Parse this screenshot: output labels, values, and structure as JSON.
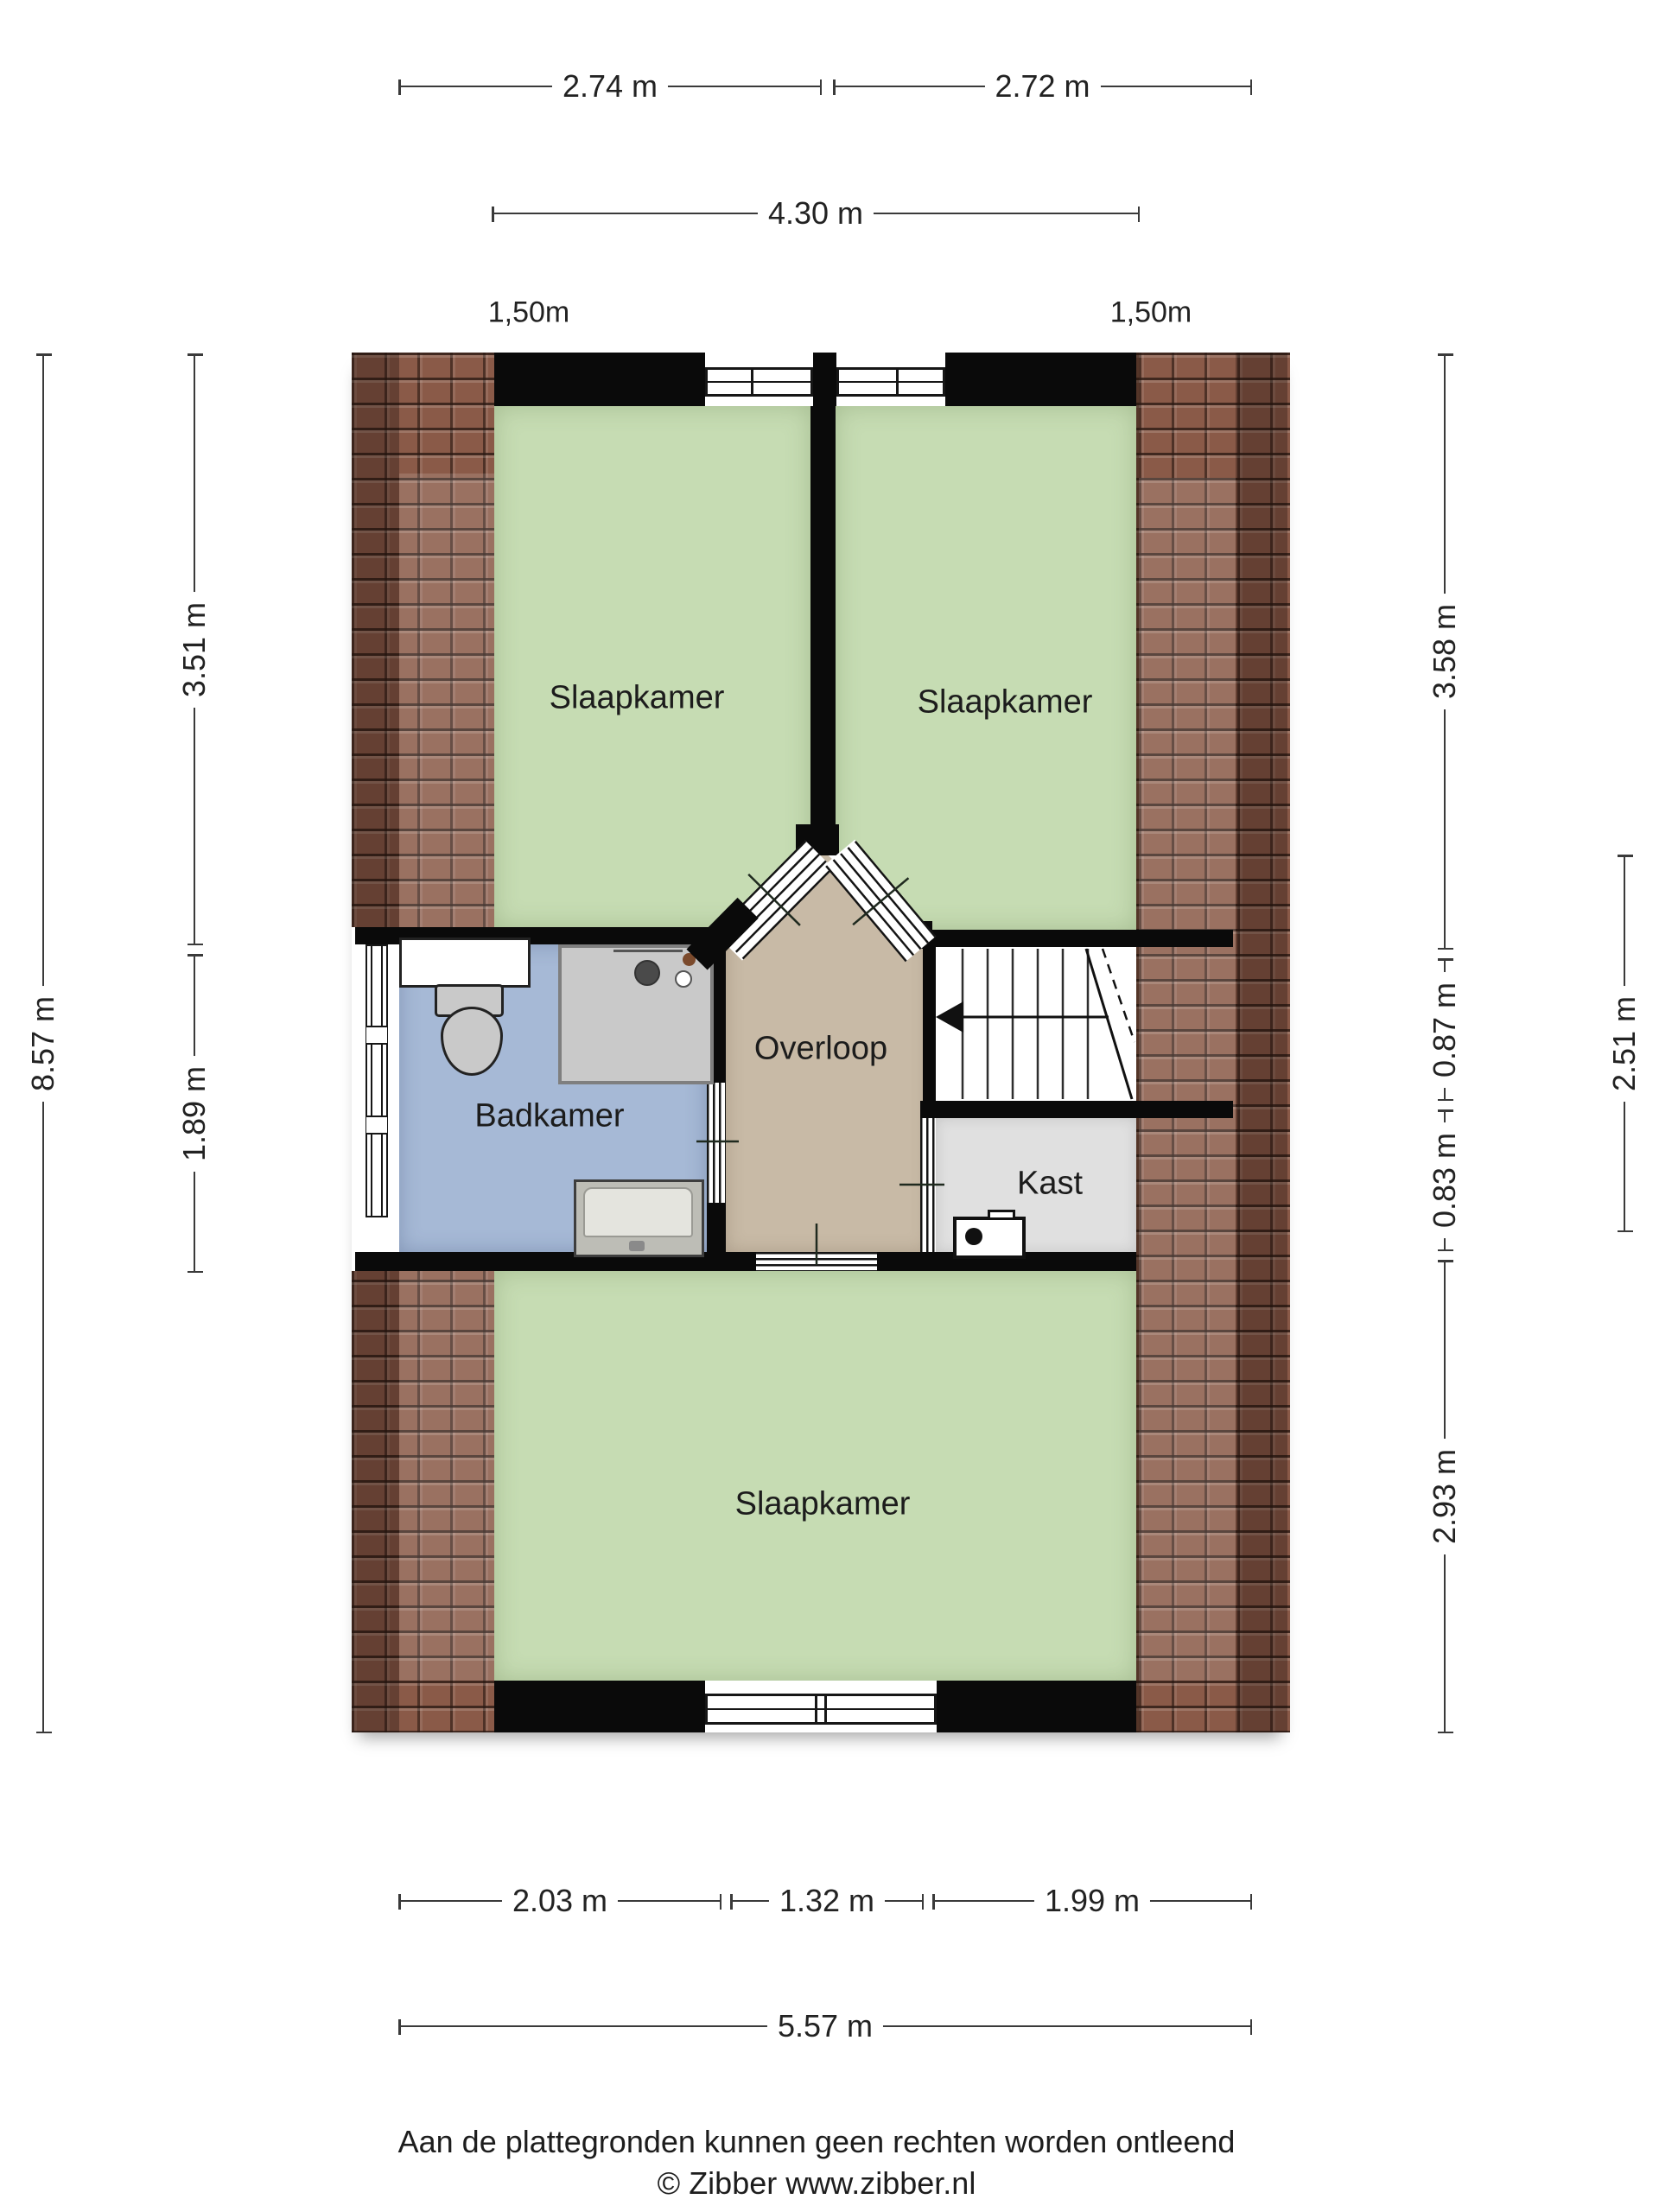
{
  "rooms": {
    "bedroom_top_left": {
      "label": "Slaapkamer"
    },
    "bedroom_top_right": {
      "label": "Slaapkamer"
    },
    "bedroom_bottom": {
      "label": "Slaapkamer"
    },
    "bathroom": {
      "label": "Badkamer"
    },
    "landing": {
      "label": "Overloop"
    },
    "closet": {
      "label": "Kast"
    }
  },
  "dimensions": {
    "top_row1_left": "2.74 m",
    "top_row1_right": "2.72 m",
    "top_row2": "4.30 m",
    "knee_height_left": "1,50m",
    "knee_height_right": "1,50m",
    "left_inner_upper": "3.51 m",
    "left_inner_lower": "1.89 m",
    "left_outer": "8.57 m",
    "right_inner_upper": "3.58 m",
    "right_inner_mid_upper": "0.87 m",
    "right_inner_mid_lower": "0.83 m",
    "right_inner_lower": "2.93 m",
    "right_outer": "2.51 m",
    "bottom_row1_left": "2.03 m",
    "bottom_row1_mid": "1.32 m",
    "bottom_row1_right": "1.99 m",
    "bottom_row2": "5.57 m"
  },
  "footer": {
    "disclaimer": "Aan de plattegronden kunnen geen rechten worden ontleend",
    "copyright": "© Zibber www.zibber.nl"
  },
  "colors": {
    "background": "#ffffff",
    "wall": "#0a0a0a",
    "room_green": "#c6dcb3",
    "bathroom_blue": "#a6b9d6",
    "landing_tan": "#c8baa6",
    "closet_gray": "#e0e0e0",
    "tile_base": "#8a5a48",
    "dim_line": "#3a3a3a",
    "text": "#1d1d1d",
    "fixture_gray": "#c9c9c9"
  }
}
